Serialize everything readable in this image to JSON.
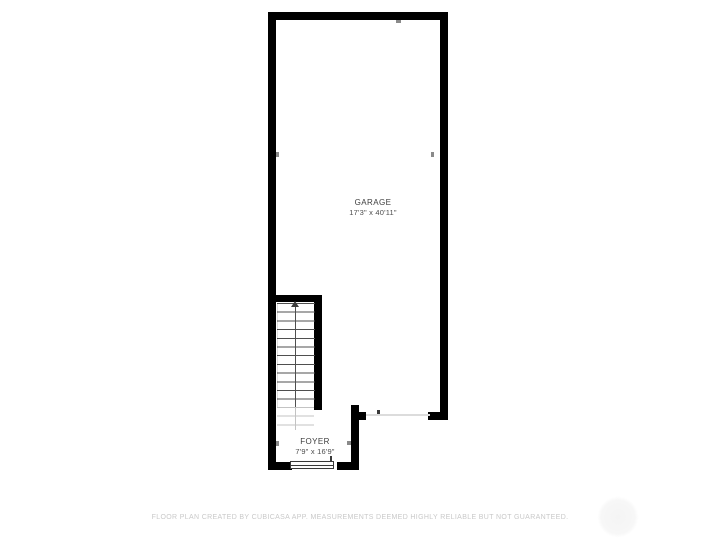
{
  "plan": {
    "rooms": [
      {
        "id": "garage",
        "name": "GARAGE",
        "dimensions": "17'3\" x 40'11\""
      },
      {
        "id": "foyer",
        "name": "FOYER",
        "dimensions": "7'9\" x 16'9\""
      }
    ],
    "stairs": {
      "direction": "up"
    }
  },
  "footer": {
    "disclaimer": "FLOOR PLAN CREATED BY CUBICASA APP. MEASUREMENTS DEEMED HIGHLY RELIABLE BUT NOT GUARANTEED."
  },
  "colors": {
    "wall": "#000000",
    "step": "#4f4f4f",
    "step_faded": "#c3c3c3",
    "opening": "#dcdcdc",
    "door": "#3a3a3a",
    "label": "#3d3d3d",
    "dims": "#4d4d4d",
    "tick": "#8a8a8a",
    "disclaimer": "#c9c9c9"
  }
}
